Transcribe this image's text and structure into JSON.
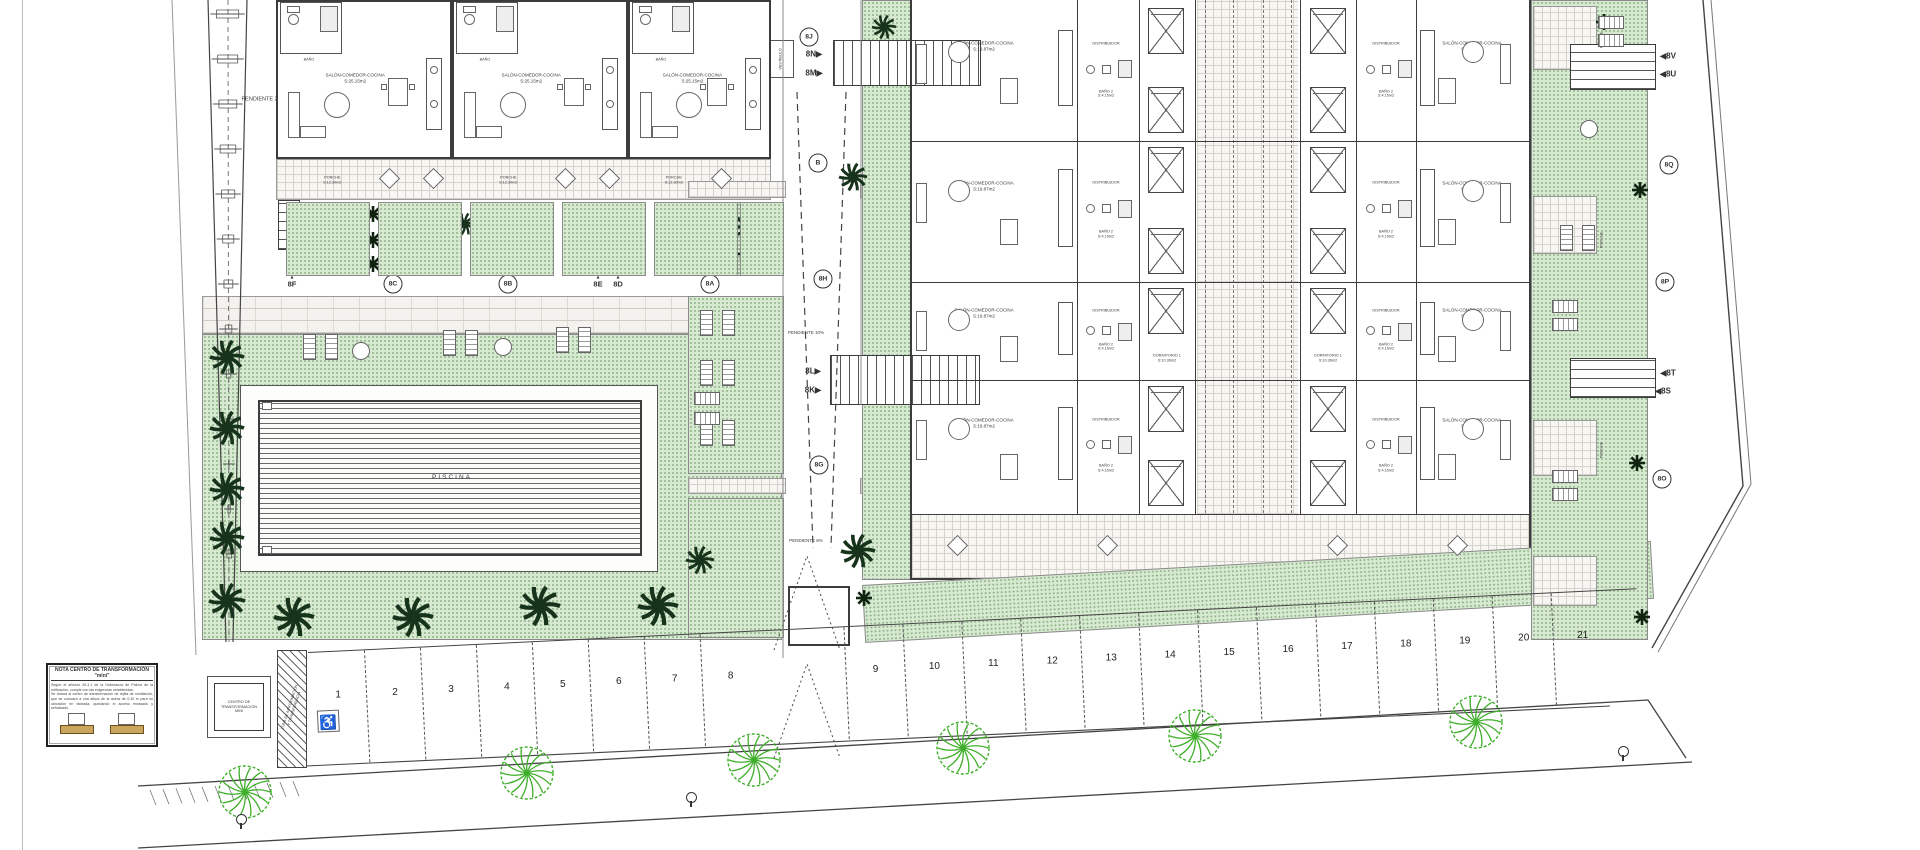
{
  "colors": {
    "green": "#d7e9d1",
    "green_dot": "#8db487",
    "palm": "#17331b",
    "shrub": "#10240f",
    "tree": "#3fae2a",
    "tan": "#caa65f",
    "line": "#444444"
  },
  "rooms": {
    "salon": "SALÓN-COMEDOR-COCINA",
    "salon_area_th": "S:25.15m2",
    "salon_area_ap": "S:19.87m2",
    "dorm1": "DORMITORIO 1",
    "dorm1_area": "S:10.36m2",
    "dorm2": "DORMITORIO 2",
    "dorm2_area": "S:8.10m2",
    "bano": "BAÑO",
    "bano_area": "S:3.70m2",
    "bano2": "BAÑO 2",
    "bano2_area": "S:4.15m2",
    "distribuidor": "DISTRIBUIDOR",
    "porche": "PORCHE",
    "porche_area": "S:12.30m2",
    "vestibulo": "VESTÍBULO",
    "piscina": "PISCINA"
  },
  "slopes": {
    "p2": "PENDIENTE 2%",
    "p8": "PENDIENTE 8%",
    "p10": "PENDIENTE 10%",
    "p12": "PENDIENTE 12%"
  },
  "ct": {
    "box": "CENTRO DE\nTRANSFORMACIÓN\nMINI",
    "zona": "ZONA DE APROXIMACIÓN\nY TRANSFERENCIA"
  },
  "note": {
    "title": "NOTA CENTRO DE TRANSFORMACIÓN \"mini\"",
    "lines": [
      "Según el artículo 26.3.1 de la Ordenanza de Policía de la edificación, cumple con las exigencias establecidas.",
      "Se dotará al centro de transformación de rejilla de ventilación, que se colocará a una altura de la acera de 0,30 m para su ubicación en fachada, quedando el acceso enrasado y señalizado."
    ]
  },
  "markers": [
    {
      "id": "8J",
      "style": "circle",
      "x": 809,
      "y": 37
    },
    {
      "id": "8N",
      "style": "arrow-right",
      "x": 814,
      "y": 54
    },
    {
      "id": "8M",
      "style": "arrow-right",
      "x": 814,
      "y": 73
    },
    {
      "id": "B",
      "style": "circle",
      "x": 818,
      "y": 163
    },
    {
      "id": "8H",
      "style": "circle",
      "x": 823,
      "y": 279
    },
    {
      "id": "8L",
      "style": "arrow-right",
      "x": 813,
      "y": 371
    },
    {
      "id": "8K",
      "style": "arrow-right",
      "x": 813,
      "y": 390
    },
    {
      "id": "8G",
      "style": "circle",
      "x": 819,
      "y": 465
    },
    {
      "id": "8F",
      "style": "tri",
      "x": 292,
      "y": 288
    },
    {
      "id": "8C",
      "style": "circle",
      "x": 393,
      "y": 284
    },
    {
      "id": "8B",
      "style": "circle",
      "x": 508,
      "y": 284
    },
    {
      "id": "8E",
      "style": "tri",
      "x": 598,
      "y": 288
    },
    {
      "id": "8D",
      "style": "tri",
      "x": 618,
      "y": 288
    },
    {
      "id": "8A",
      "style": "circle",
      "x": 710,
      "y": 284
    },
    {
      "id": "8V",
      "style": "arrow-left",
      "x": 1668,
      "y": 56
    },
    {
      "id": "8U",
      "style": "arrow-left",
      "x": 1668,
      "y": 74
    },
    {
      "id": "8Q",
      "style": "circle",
      "x": 1669,
      "y": 165
    },
    {
      "id": "8P",
      "style": "circle",
      "x": 1665,
      "y": 282
    },
    {
      "id": "8T",
      "style": "arrow-left",
      "x": 1668,
      "y": 373
    },
    {
      "id": "8S",
      "style": "arrow-left",
      "x": 1663,
      "y": 391
    },
    {
      "id": "8O",
      "style": "circle",
      "x": 1662,
      "y": 479
    }
  ],
  "parking": {
    "break_after": 8,
    "spaces": [
      {
        "n": "1",
        "accessible": true
      },
      {
        "n": "2"
      },
      {
        "n": "3"
      },
      {
        "n": "4"
      },
      {
        "n": "5"
      },
      {
        "n": "6"
      },
      {
        "n": "7"
      },
      {
        "n": "8"
      },
      {
        "n": "9"
      },
      {
        "n": "10"
      },
      {
        "n": "11"
      },
      {
        "n": "12"
      },
      {
        "n": "13"
      },
      {
        "n": "14"
      },
      {
        "n": "15"
      },
      {
        "n": "16"
      },
      {
        "n": "17"
      },
      {
        "n": "18"
      },
      {
        "n": "19"
      },
      {
        "n": "20"
      },
      {
        "n": "21"
      }
    ]
  },
  "townhouses": [
    {
      "x": 276,
      "w": 176
    },
    {
      "x": 452,
      "w": 176
    },
    {
      "x": 628,
      "w": 143
    }
  ],
  "gardens_th": [
    [
      286,
      84
    ],
    [
      378,
      84
    ],
    [
      470,
      84
    ],
    [
      562,
      84
    ],
    [
      654,
      84
    ],
    [
      740,
      44
    ]
  ],
  "apartment_rows": [
    {
      "y": 2,
      "h": 139,
      "beds": 2
    },
    {
      "y": 141,
      "h": 141,
      "beds": 2
    },
    {
      "y": 282,
      "h": 98,
      "beds": 1
    },
    {
      "y": 380,
      "h": 134,
      "beds": 2
    }
  ],
  "decor": {
    "street_trees": [
      [
        245,
        792
      ],
      [
        527,
        773
      ],
      [
        754,
        760
      ],
      [
        963,
        748
      ],
      [
        1195,
        736
      ],
      [
        1476,
        722
      ]
    ],
    "lamps": [
      [
        236,
        814
      ],
      [
        686,
        792
      ],
      [
        1618,
        746
      ]
    ],
    "palms": [
      [
        227,
        357,
        36
      ],
      [
        227,
        428,
        36
      ],
      [
        227,
        489,
        36
      ],
      [
        227,
        538,
        36
      ],
      [
        227,
        601,
        38
      ],
      [
        294,
        617,
        42
      ],
      [
        413,
        617,
        42
      ],
      [
        540,
        606,
        42
      ],
      [
        658,
        606,
        42
      ],
      [
        437,
        215,
        26
      ],
      [
        465,
        224,
        24
      ],
      [
        749,
        226,
        30
      ],
      [
        853,
        177,
        30
      ],
      [
        884,
        27,
        26
      ],
      [
        858,
        551,
        36
      ],
      [
        700,
        560,
        30
      ]
    ],
    "shrubs": [
      [
        373,
        214
      ],
      [
        373,
        240
      ],
      [
        373,
        264
      ],
      [
        479,
        214
      ],
      [
        479,
        240
      ],
      [
        479,
        264
      ],
      [
        746,
        254
      ],
      [
        864,
        598
      ],
      [
        1604,
        22
      ],
      [
        1640,
        190
      ],
      [
        1637,
        463
      ],
      [
        1642,
        617
      ]
    ],
    "sunbeds_v": [
      [
        296,
        222
      ],
      [
        318,
        222
      ],
      [
        388,
        222
      ],
      [
        410,
        222
      ],
      [
        480,
        222
      ],
      [
        502,
        222
      ],
      [
        572,
        222
      ],
      [
        594,
        222
      ],
      [
        664,
        222
      ],
      [
        686,
        222
      ],
      [
        303,
        334
      ],
      [
        325,
        334
      ],
      [
        443,
        330
      ],
      [
        465,
        330
      ],
      [
        556,
        327
      ],
      [
        578,
        327
      ],
      [
        700,
        310
      ],
      [
        722,
        310
      ],
      [
        700,
        360
      ],
      [
        722,
        360
      ],
      [
        700,
        420
      ],
      [
        722,
        420
      ],
      [
        1560,
        225
      ],
      [
        1582,
        225
      ]
    ],
    "sunbeds_h": [
      [
        694,
        392
      ],
      [
        694,
        412
      ],
      [
        1598,
        16
      ],
      [
        1598,
        34
      ],
      [
        1552,
        300
      ],
      [
        1552,
        318
      ],
      [
        1552,
        470
      ],
      [
        1552,
        488
      ]
    ],
    "round_tables": [
      [
        352,
        342
      ],
      [
        494,
        338
      ],
      [
        1580,
        120
      ]
    ]
  }
}
